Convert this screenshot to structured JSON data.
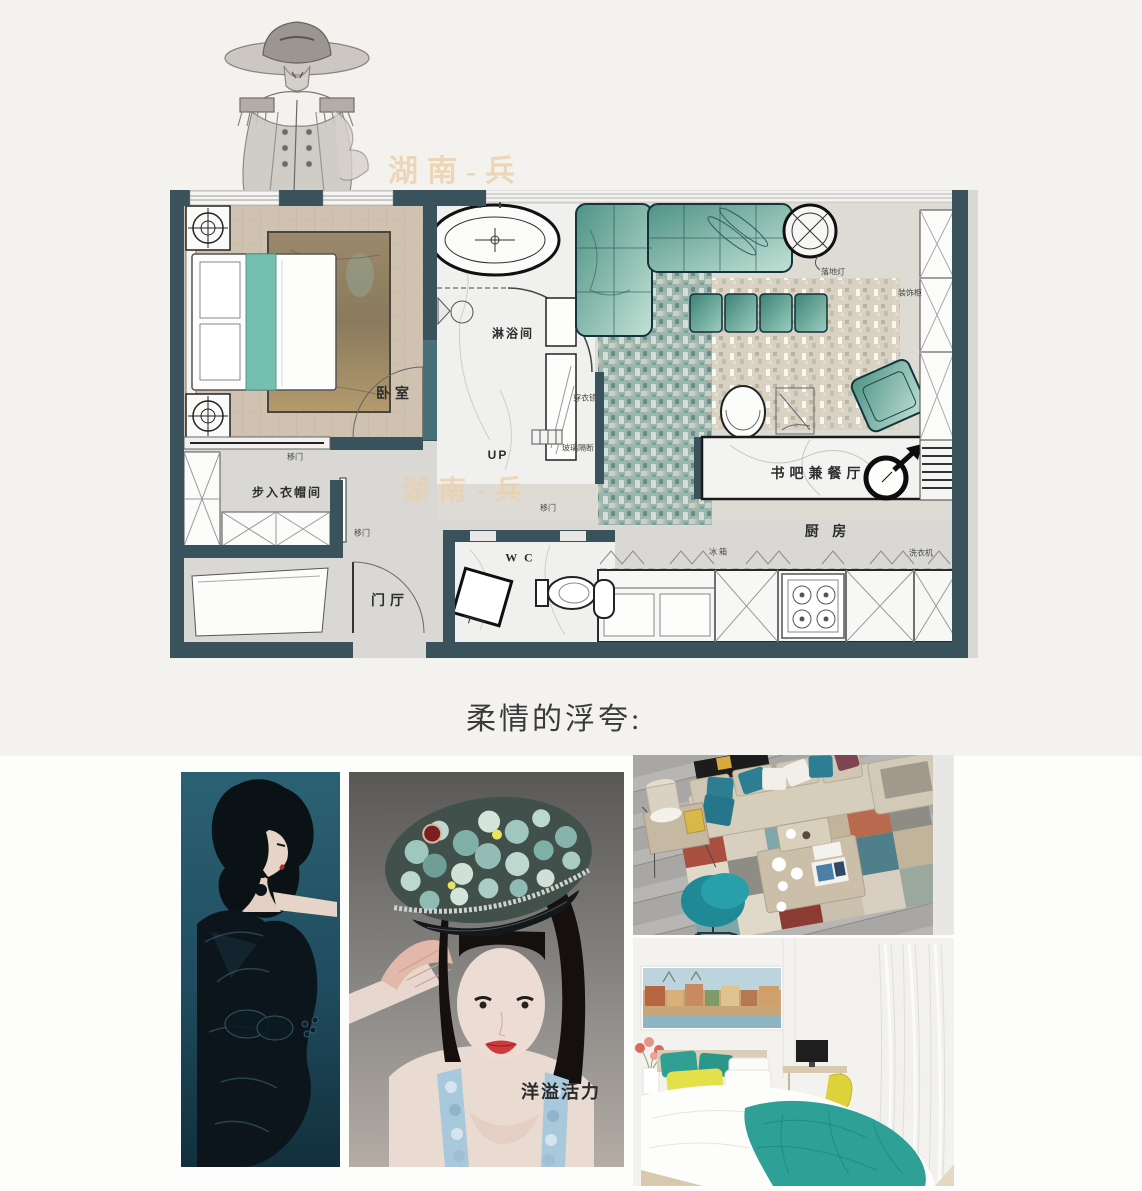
{
  "header": {
    "watermark": "湖南-兵"
  },
  "floorplan": {
    "watermark": "湖南-兵",
    "rooms": {
      "bedroom": "卧室",
      "shower": "淋浴间",
      "walk_in_closet": "步入衣帽间",
      "entry_hall": "门厅",
      "wc": "W C",
      "book_bar_dining": "书吧兼餐厅",
      "kitchen": "厨 房"
    },
    "annotations": {
      "up": "UP",
      "sliding_door": "移门",
      "floor_lamp": "落地灯",
      "decor_cabinet": "装饰柜",
      "fridge": "冰 箱",
      "washing_machine": "洗衣机",
      "dressing_mirror": "穿衣镜",
      "glass_partition": "玻璃隔断"
    }
  },
  "section": {
    "title": "柔情的浮夸:"
  },
  "gallery": {
    "painting_caption": "洋溢活力"
  },
  "colors": {
    "accent_teal": "#2f9a8d",
    "plan_wall": "#3a525b",
    "watermark": "#ecd0a9",
    "page_background": "#f4f2ef"
  }
}
